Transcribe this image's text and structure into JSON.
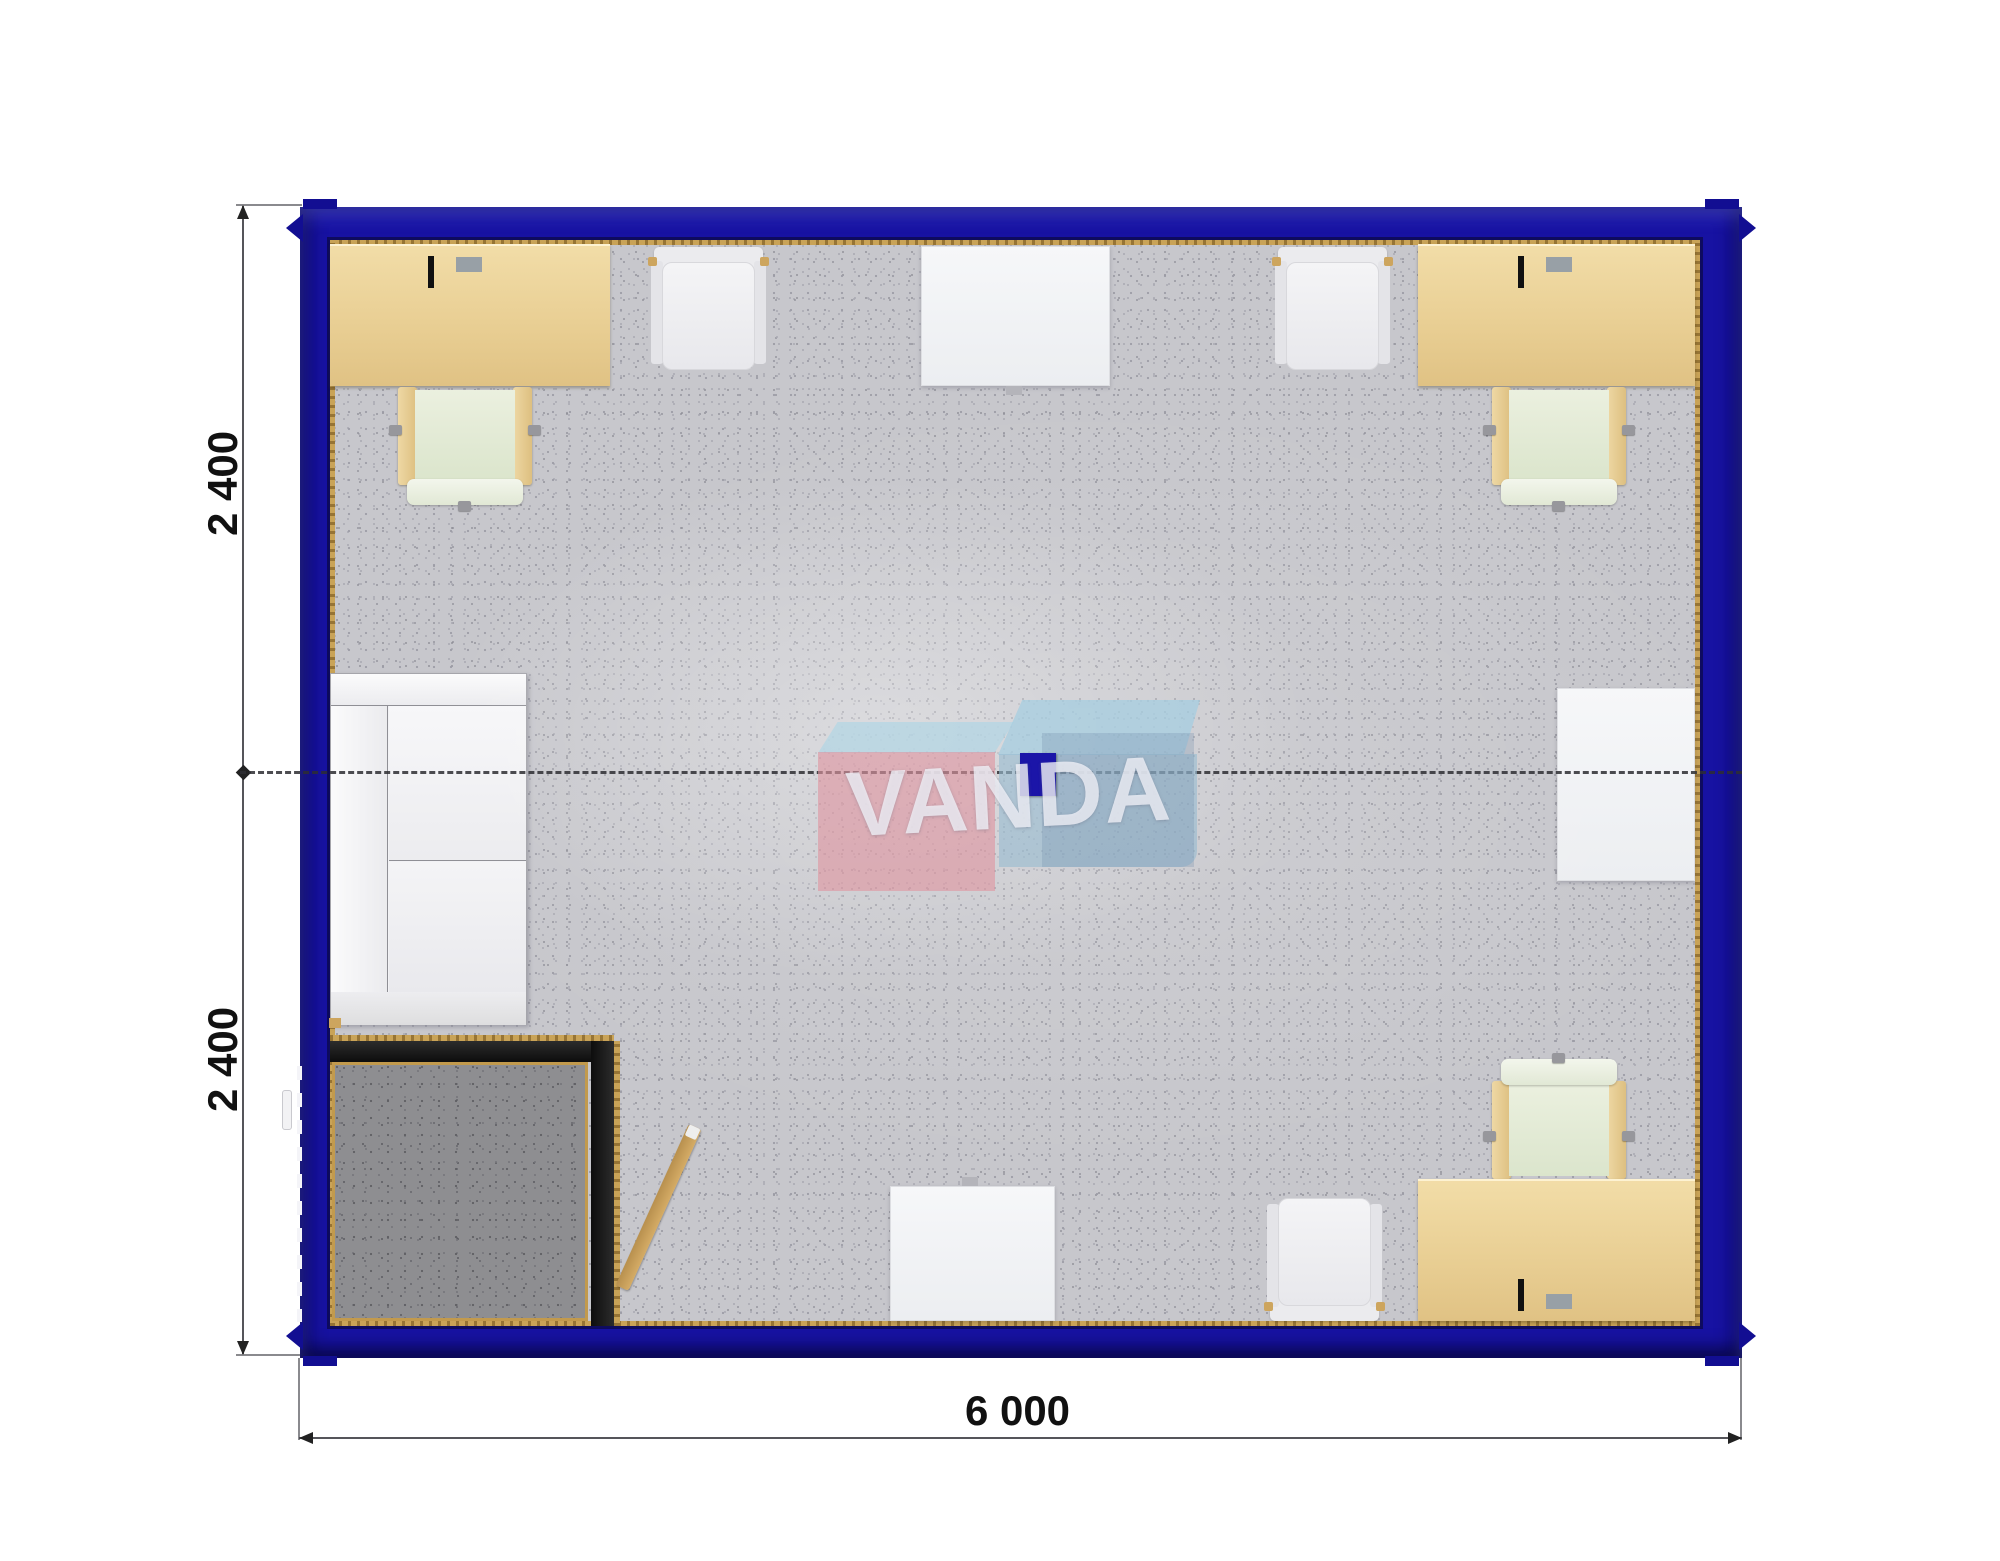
{
  "watermark": {
    "text": "VANDA"
  },
  "dimensions": {
    "height_top_label": "2 400",
    "height_bottom_label": "2 400",
    "width_label": "6 000"
  },
  "colors": {
    "frame_blue": "#1712a2",
    "frame_blue_dark": "#120e92",
    "trim_gold": "#c9a357",
    "carpet_light": "#c7c7cc",
    "carpet_dark": "#8e8e91",
    "desk_beige": "#e9cf94",
    "chair_seat_green": "#e3ead6",
    "furniture_white": "#f2f2f5",
    "wall_black": "#161616",
    "watermark_pink": "#de94a0",
    "watermark_blue": "#98bbd0",
    "watermark_navy": "#1b15a8",
    "dimension_text": "#111111"
  },
  "furniture": {
    "items": [
      "desk-with-laptop-top-left",
      "office-chair-top-left",
      "white-chair-top-left",
      "white-table-top",
      "white-chair-top-right",
      "desk-with-laptop-top-right",
      "office-chair-top-right",
      "sofa-left",
      "white-table-right",
      "dark-vestibule-room",
      "entrance-door-leaf",
      "white-table-bottom",
      "white-chair-bottom",
      "office-chair-bottom-right",
      "desk-with-laptop-bottom-right"
    ]
  }
}
